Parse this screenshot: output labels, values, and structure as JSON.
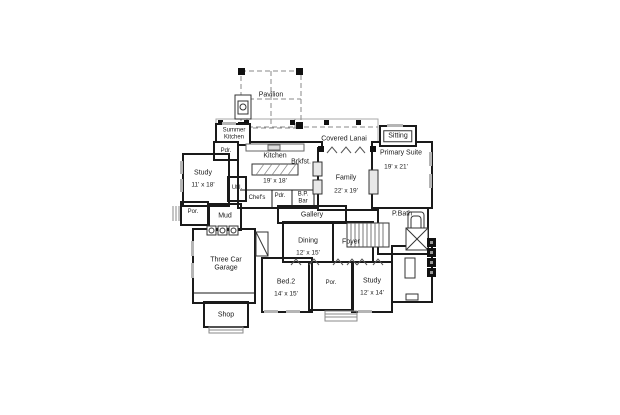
{
  "document": {
    "type": "architectural floor plan"
  },
  "colors": {
    "wall": "#1a1a1a",
    "window_gray": "#b5b5b5",
    "roof_dash_gray": "#8a8a8a",
    "background": "#ffffff"
  },
  "labels": {
    "pavilion": "Pavilion",
    "summer_kitchen": "Summer\nKitchen",
    "covered_lanai": "Covered Lanai",
    "sitting": "Sitting",
    "primary_suite": "Primary Suite",
    "primary_suite_dims": "19' x 21'",
    "kitchen": "Kitchen",
    "kitchen_dims": "19' x 18'",
    "brkfst": "Brkfst.",
    "pdr_top": "Pdr.",
    "study_left": "Study",
    "study_left_dims": "11' x 18'",
    "util": "Util.",
    "chefs": "Chef's",
    "pdr_mid": "Pdr.",
    "bp_bar": "B.P.\nBar",
    "family": "Family",
    "family_dims": "22' x 19'",
    "por_left": "Por.",
    "mud": "Mud",
    "gallery": "Gallery",
    "p_bath": "P.Bath",
    "dining": "Dining",
    "dining_dims": "12' x 15'",
    "foyer": "Foyer",
    "three_car_garage": "Three Car\nGarage",
    "bed2": "Bed.2",
    "bed2_dims": "14' x 15'",
    "por_bottom": "Por.",
    "study_right": "Study",
    "study_right_dims": "12' x 14'",
    "shop": "Shop"
  }
}
